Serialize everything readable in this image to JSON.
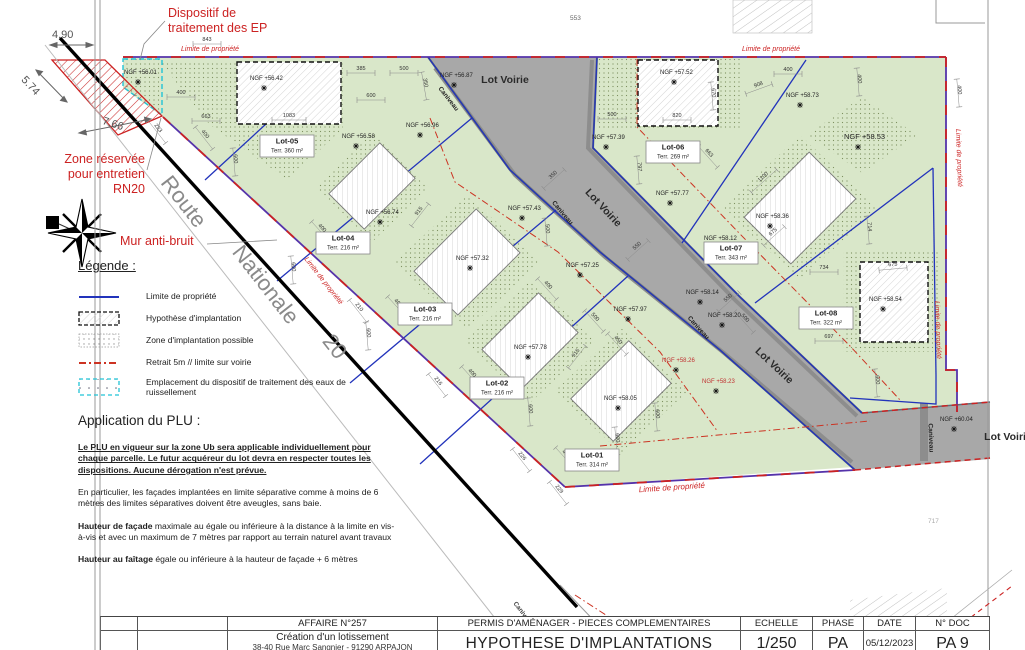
{
  "colors": {
    "green": "#d9e7c9",
    "dot_green": "#7d9160",
    "road_grey": "#a8a8a8",
    "boundary_purple": "#5533aa",
    "boundary_red": "#cc2222",
    "blue_line": "#2233bb",
    "annotation_red": "#cc2222",
    "cyan": "#22c3d6"
  },
  "legend": {
    "title": "Légende :",
    "items": [
      {
        "icon": "blue-line-icon",
        "label": "Limite de propriété"
      },
      {
        "icon": "hatch-box-icon",
        "label": "Hypothèse d'implantation"
      },
      {
        "icon": "dots-box-icon",
        "label": "Zone d'implantation possible"
      },
      {
        "icon": "red-dashdot-icon",
        "label": "Retrait 5m // limite sur voirie"
      },
      {
        "icon": "cyan-box-icon",
        "label": "Emplacement du dispositif de traitement des eaux de ruissellement"
      }
    ]
  },
  "plu": {
    "title": "Application du PLU :",
    "p1": "Le PLU en vigueur sur la zone Ub sera applicable individuellement pour chaque parcelle. Le futur acquéreur du lot devra en respecter toutes les dispositions.  Aucune dérogation n'est prévue.",
    "p2": "En particulier, les façades implantées en limite séparative comme à  moins de 6 mètres des limites séparatives doivent être aveugles, sans baie.",
    "p3_lead": "Hauteur de façade",
    "p3_rest": " maximale au égale ou inférieure à la distance à la limite en vis-à-vis et avec un maximum de 7 mètres par rapport au terrain naturel avant travaux",
    "p4_lead": "Hauteur au faîtage",
    "p4_rest": " égale ou inférieure à la hauteur de façade + 6 mètres"
  },
  "title_block": {
    "affaire_label": "AFFAIRE N°257",
    "permis_label": "PERMIS D'AMÉNAGER - PIECES COMPLEMENTAIRES",
    "echelle_label": "ECHELLE",
    "phase_label": "PHASE",
    "date_label": "DATE",
    "doc_label": "N° DOC",
    "project_title": "Création d'un lotissement",
    "project_address": "38-40 Rue Marc Sangnier - 91290 ARPAJON",
    "doc_title": "HYPOTHESE D'IMPLANTATIONS",
    "echelle_value": "1/250",
    "phase_value": "PA",
    "date_value": "05/12/2023",
    "doc_value": "PA 9"
  },
  "plan": {
    "lots": [
      {
        "name": "Lot-01",
        "area": "Terr. 314 m²",
        "x": 592,
        "y": 460
      },
      {
        "name": "Lot-02",
        "area": "Terr. 216 m²",
        "x": 497,
        "y": 388
      },
      {
        "name": "Lot-03",
        "area": "Terr. 216 m²",
        "x": 425,
        "y": 314
      },
      {
        "name": "Lot-04",
        "area": "Terr. 216 m²",
        "x": 343,
        "y": 243
      },
      {
        "name": "Lot-05",
        "area": "Terr. 360 m²",
        "x": 287,
        "y": 146
      },
      {
        "name": "Lot-06",
        "area": "Terr. 269 m²",
        "x": 673,
        "y": 152
      },
      {
        "name": "Lot-07",
        "area": "Terr. 343 m²",
        "x": 731,
        "y": 253
      },
      {
        "name": "Lot-08",
        "area": "Terr. 322 m²",
        "x": 826,
        "y": 318
      }
    ],
    "ngf": [
      {
        "t": "NGF +56.01",
        "x": 124,
        "y": 74
      },
      {
        "t": "NGF +56.42",
        "x": 250,
        "y": 80
      },
      {
        "t": "NGF +56.87",
        "x": 440,
        "y": 77
      },
      {
        "t": "NGF +56.96",
        "x": 406,
        "y": 127
      },
      {
        "t": "NGF +56.58",
        "x": 342,
        "y": 138
      },
      {
        "t": "NGF +56.74",
        "x": 366,
        "y": 214
      },
      {
        "t": "NGF +57.32",
        "x": 456,
        "y": 260
      },
      {
        "t": "NGF +57.43",
        "x": 508,
        "y": 210
      },
      {
        "t": "NGF +57.25",
        "x": 566,
        "y": 267
      },
      {
        "t": "NGF +57.97",
        "x": 614,
        "y": 311
      },
      {
        "t": "NGF +57.78",
        "x": 514,
        "y": 349
      },
      {
        "t": "NGF +58.05",
        "x": 604,
        "y": 400
      },
      {
        "t": "NGF +57.39",
        "x": 592,
        "y": 139
      },
      {
        "t": "NGF +57.52",
        "x": 660,
        "y": 74
      },
      {
        "t": "NGF +57.77",
        "x": 656,
        "y": 195
      },
      {
        "t": "NGF +58.73",
        "x": 786,
        "y": 97
      },
      {
        "t": "NGF +58.53",
        "x": 844,
        "y": 139,
        "big": true
      },
      {
        "t": "NGF +58.36",
        "x": 756,
        "y": 218
      },
      {
        "t": "NGF +58.12",
        "x": 704,
        "y": 240
      },
      {
        "t": "NGF +58.14",
        "x": 686,
        "y": 294
      },
      {
        "t": "NGF +58.20",
        "x": 708,
        "y": 317
      },
      {
        "t": "NGF +58.54",
        "x": 869,
        "y": 301
      },
      {
        "t": "NGF +58.26",
        "x": 662,
        "y": 362,
        "red": true
      },
      {
        "t": "NGF +58.23",
        "x": 702,
        "y": 383,
        "red": true
      },
      {
        "t": "NGF +60.04",
        "x": 940,
        "y": 421
      }
    ],
    "dims": [
      {
        "t": "843",
        "x": 207,
        "y": 41,
        "r": 0
      },
      {
        "t": "400",
        "x": 181,
        "y": 94,
        "r": 0
      },
      {
        "t": "663",
        "x": 206,
        "y": 118,
        "r": 0
      },
      {
        "t": "1083",
        "x": 289,
        "y": 117,
        "r": 0
      },
      {
        "t": "385",
        "x": 361,
        "y": 70,
        "r": 0
      },
      {
        "t": "500",
        "x": 404,
        "y": 70,
        "r": 0
      },
      {
        "t": "350",
        "x": 424,
        "y": 83,
        "r": 80
      },
      {
        "t": "600",
        "x": 371,
        "y": 97,
        "r": 0
      },
      {
        "t": "400",
        "x": 204,
        "y": 135,
        "r": 52
      },
      {
        "t": "600",
        "x": 234,
        "y": 159,
        "r": 85
      },
      {
        "t": "400",
        "x": 321,
        "y": 229,
        "r": 48
      },
      {
        "t": "600",
        "x": 292,
        "y": 267,
        "r": 85
      },
      {
        "t": "400",
        "x": 397,
        "y": 304,
        "r": 48
      },
      {
        "t": "600",
        "x": 367,
        "y": 333,
        "r": 85
      },
      {
        "t": "400",
        "x": 471,
        "y": 374,
        "r": 48
      },
      {
        "t": "600",
        "x": 529,
        "y": 409,
        "r": 85
      },
      {
        "t": "400",
        "x": 565,
        "y": 455,
        "r": 48
      },
      {
        "t": "600",
        "x": 616,
        "y": 438,
        "r": 85
      },
      {
        "t": "915",
        "x": 420,
        "y": 212,
        "r": -52
      },
      {
        "t": "915",
        "x": 577,
        "y": 354,
        "r": -52
      },
      {
        "t": "223",
        "x": 157,
        "y": 129,
        "r": 52
      },
      {
        "t": "210",
        "x": 358,
        "y": 308,
        "r": 52
      },
      {
        "t": "216",
        "x": 437,
        "y": 382,
        "r": 52
      },
      {
        "t": "226",
        "x": 521,
        "y": 457,
        "r": 52
      },
      {
        "t": "229",
        "x": 558,
        "y": 490,
        "r": 52
      },
      {
        "t": "350",
        "x": 554,
        "y": 176,
        "r": -42
      },
      {
        "t": "550",
        "x": 638,
        "y": 247,
        "r": -42
      },
      {
        "t": "500",
        "x": 546,
        "y": 229,
        "r": 85
      },
      {
        "t": "400",
        "x": 547,
        "y": 286,
        "r": 48
      },
      {
        "t": "500",
        "x": 594,
        "y": 318,
        "r": 48
      },
      {
        "t": "450",
        "x": 617,
        "y": 341,
        "r": 48
      },
      {
        "t": "500",
        "x": 612,
        "y": 116,
        "r": 0
      },
      {
        "t": "820",
        "x": 677,
        "y": 117,
        "r": 0
      },
      {
        "t": "670",
        "x": 712,
        "y": 93,
        "r": 85
      },
      {
        "t": "400",
        "x": 788,
        "y": 71,
        "r": 0
      },
      {
        "t": "908",
        "x": 759,
        "y": 86,
        "r": -20
      },
      {
        "t": "400",
        "x": 858,
        "y": 79,
        "r": 85
      },
      {
        "t": "400",
        "x": 958,
        "y": 90,
        "r": 85
      },
      {
        "t": "663",
        "x": 708,
        "y": 154,
        "r": 48
      },
      {
        "t": "797",
        "x": 638,
        "y": 167,
        "r": 85
      },
      {
        "t": "1100",
        "x": 764,
        "y": 178,
        "r": -42
      },
      {
        "t": "675",
        "x": 774,
        "y": 233,
        "r": -42
      },
      {
        "t": "714",
        "x": 868,
        "y": 227,
        "r": 85
      },
      {
        "t": "734",
        "x": 824,
        "y": 269,
        "r": 0
      },
      {
        "t": "675",
        "x": 893,
        "y": 266,
        "r": -5
      },
      {
        "t": "697",
        "x": 829,
        "y": 338,
        "r": 0
      },
      {
        "t": "550",
        "x": 729,
        "y": 299,
        "r": -42
      },
      {
        "t": "500",
        "x": 744,
        "y": 319,
        "r": 48
      },
      {
        "t": "600",
        "x": 876,
        "y": 380,
        "r": 85
      },
      {
        "t": "600",
        "x": 656,
        "y": 414,
        "r": 85
      }
    ],
    "texts": [
      {
        "t": "Dispositif de",
        "x": 168,
        "y": 17,
        "s": 12.5,
        "c": "#cc2222",
        "n": "annotation-dispositif-ep"
      },
      {
        "t": "traitement des EP",
        "x": 168,
        "y": 32,
        "s": 12.5,
        "c": "#cc2222",
        "n": "annotation-dispositif-ep"
      },
      {
        "t": "4.90",
        "x": 52,
        "y": 38,
        "s": 11,
        "c": "#555",
        "n": "dim-4-90"
      },
      {
        "t": "5.74",
        "x": 28,
        "y": 88,
        "s": 11,
        "c": "#555",
        "r": 47,
        "a": "middle",
        "n": "dim-5-74"
      },
      {
        "t": "7.66",
        "x": 112,
        "y": 127,
        "s": 11,
        "c": "#555",
        "r": 18,
        "a": "middle",
        "n": "dim-7-66"
      },
      {
        "t": "Zone réservée",
        "x": 145,
        "y": 163,
        "s": 12.5,
        "c": "#cc2222",
        "a": "end",
        "n": "annotation-zone-reservee"
      },
      {
        "t": "pour entretien",
        "x": 145,
        "y": 178,
        "s": 12.5,
        "c": "#cc2222",
        "a": "end",
        "n": "annotation-zone-reservee"
      },
      {
        "t": "RN20",
        "x": 145,
        "y": 193,
        "s": 12.5,
        "c": "#cc2222",
        "a": "end",
        "n": "annotation-zone-reservee"
      },
      {
        "t": "Mur anti-bruit",
        "x": 120,
        "y": 245,
        "s": 12.5,
        "c": "#cc2222",
        "n": "annotation-mur-anti-bruit"
      },
      {
        "t": "Route",
        "x": 178,
        "y": 206,
        "s": 22,
        "c": "#8a8a8a",
        "r": 52,
        "a": "middle",
        "n": "route-nationale-label"
      },
      {
        "t": "Nationale",
        "x": 260,
        "y": 289,
        "s": 22,
        "c": "#8a8a8a",
        "r": 52,
        "a": "middle",
        "n": "route-nationale-label"
      },
      {
        "t": "20",
        "x": 329,
        "y": 351,
        "s": 22,
        "c": "#8a8a8a",
        "r": 52,
        "a": "middle",
        "n": "route-nationale-label"
      },
      {
        "t": "Limite de propriété",
        "x": 181,
        "y": 51,
        "s": 7,
        "c": "#cc2222",
        "i": 1,
        "n": "limite-propriete-label"
      },
      {
        "t": "Limite de propriété",
        "x": 742,
        "y": 51,
        "s": 7,
        "c": "#cc2222",
        "i": 1,
        "n": "limite-propriete-label"
      },
      {
        "t": "Limite de propriété",
        "x": 322,
        "y": 282,
        "s": 7,
        "c": "#cc2222",
        "i": 1,
        "r": 52,
        "a": "middle",
        "n": "limite-propriete-label"
      },
      {
        "t": "Limite de propriété",
        "x": 957,
        "y": 158,
        "s": 7,
        "c": "#cc2222",
        "i": 1,
        "r": 88,
        "a": "middle",
        "n": "limite-propriete-label"
      },
      {
        "t": "Limite de propriété",
        "x": 936,
        "y": 330,
        "s": 7,
        "c": "#cc2222",
        "i": 1,
        "r": 88,
        "a": "middle",
        "n": "limite-propriete-label"
      },
      {
        "t": "Limite de propriété",
        "x": 672,
        "y": 490,
        "s": 8,
        "c": "#cc2222",
        "i": 1,
        "r": -4,
        "a": "middle",
        "n": "limite-propriete-label"
      },
      {
        "t": "553",
        "x": 570,
        "y": 20,
        "s": 6.5,
        "c": "#666",
        "n": "ref-553"
      },
      {
        "t": "717",
        "x": 928,
        "y": 523,
        "s": 6.5,
        "c": "#aaa",
        "n": "ref-717"
      },
      {
        "t": "Lot Voirie",
        "x": 505,
        "y": 83,
        "s": 10.5,
        "c": "#2a2a2a",
        "w": "bold",
        "a": "middle",
        "n": "lot-voirie-label"
      },
      {
        "t": "Lot Voirie",
        "x": 601,
        "y": 210,
        "s": 10.5,
        "c": "#2a2a2a",
        "w": "bold",
        "r": 47,
        "a": "middle",
        "n": "lot-voirie-label"
      },
      {
        "t": "Lot Voirie",
        "x": 772,
        "y": 368,
        "s": 10.5,
        "c": "#2a2a2a",
        "w": "bold",
        "r": 43,
        "a": "middle",
        "n": "lot-voirie-label"
      },
      {
        "t": "Lot Voirie",
        "x": 1008,
        "y": 440,
        "s": 10.5,
        "c": "#2a2a2a",
        "w": "bold",
        "a": "middle",
        "n": "lot-voirie-label"
      },
      {
        "t": "Caniveau",
        "x": 447,
        "y": 100,
        "s": 6.5,
        "c": "#222",
        "w": "bold",
        "r": 52,
        "a": "middle",
        "n": "caniveau-label"
      },
      {
        "t": "Caniveau",
        "x": 561,
        "y": 214,
        "s": 6.5,
        "c": "#222",
        "w": "bold",
        "r": 50,
        "a": "middle",
        "n": "caniveau-label"
      },
      {
        "t": "Caniveau",
        "x": 697,
        "y": 329,
        "s": 6.5,
        "c": "#222",
        "w": "bold",
        "r": 48,
        "a": "middle",
        "n": "caniveau-label"
      },
      {
        "t": "Caniveau",
        "x": 929,
        "y": 438,
        "s": 6.5,
        "c": "#222",
        "w": "bold",
        "r": 88,
        "a": "middle",
        "n": "caniveau-label"
      },
      {
        "t": "Caniveau",
        "x": 522,
        "y": 615,
        "s": 6.5,
        "c": "#444",
        "w": "bold",
        "r": 52,
        "a": "middle",
        "n": "caniveau-label"
      }
    ]
  }
}
